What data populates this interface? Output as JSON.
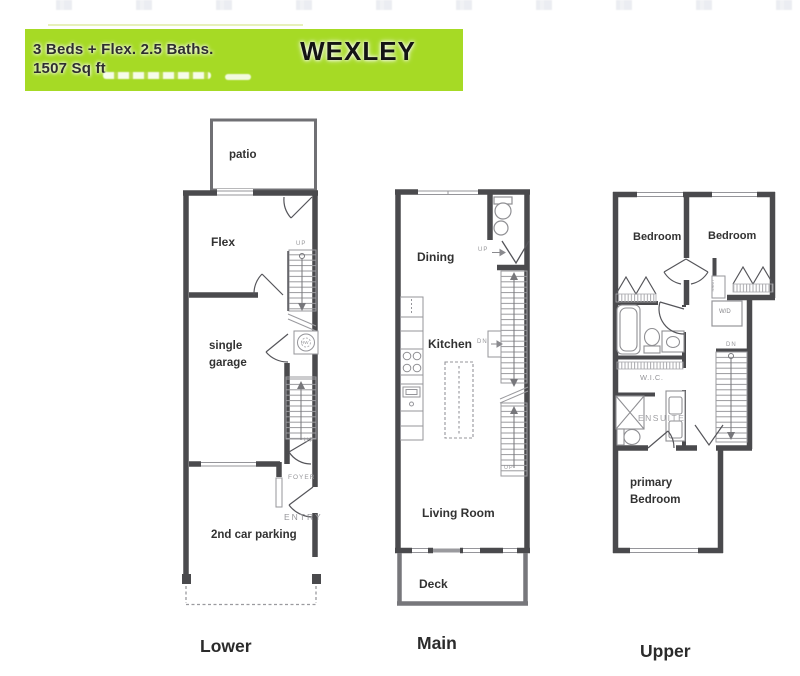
{
  "header": {
    "specs_line1": "3 Beds + Flex. 2.5 Baths.",
    "specs_line2": "1507 Sq ft",
    "title": "WEXLEY"
  },
  "colors": {
    "header_bg": "#a6da25",
    "wall": "#4a4a4d",
    "label_text": "#323232",
    "muted_text": "#96969a"
  },
  "floors": {
    "lower": {
      "label": "Lower",
      "patio": "patio",
      "flex": "Flex",
      "garage": "single\ngarage",
      "parking": "2nd car parking",
      "foyer": "FOYER",
      "entry": "ENTRY",
      "up_top": "UP",
      "up_bottom": "UP",
      "hw": "HW"
    },
    "main": {
      "label": "Main",
      "dining": "Dining",
      "kitchen": "Kitchen",
      "living": "Living Room",
      "deck": "Deck",
      "up": "UP",
      "dn": "DN",
      "up_small": "UP"
    },
    "upper": {
      "label": "Upper",
      "bedroom1": "Bedroom",
      "bedroom2": "Bedroom",
      "wic": "W.I.C.",
      "ensuite": "ENSUITE",
      "wd": "W/D",
      "linen": "LINEN",
      "primary": "primary\nBedroom",
      "dn": "DN"
    }
  }
}
